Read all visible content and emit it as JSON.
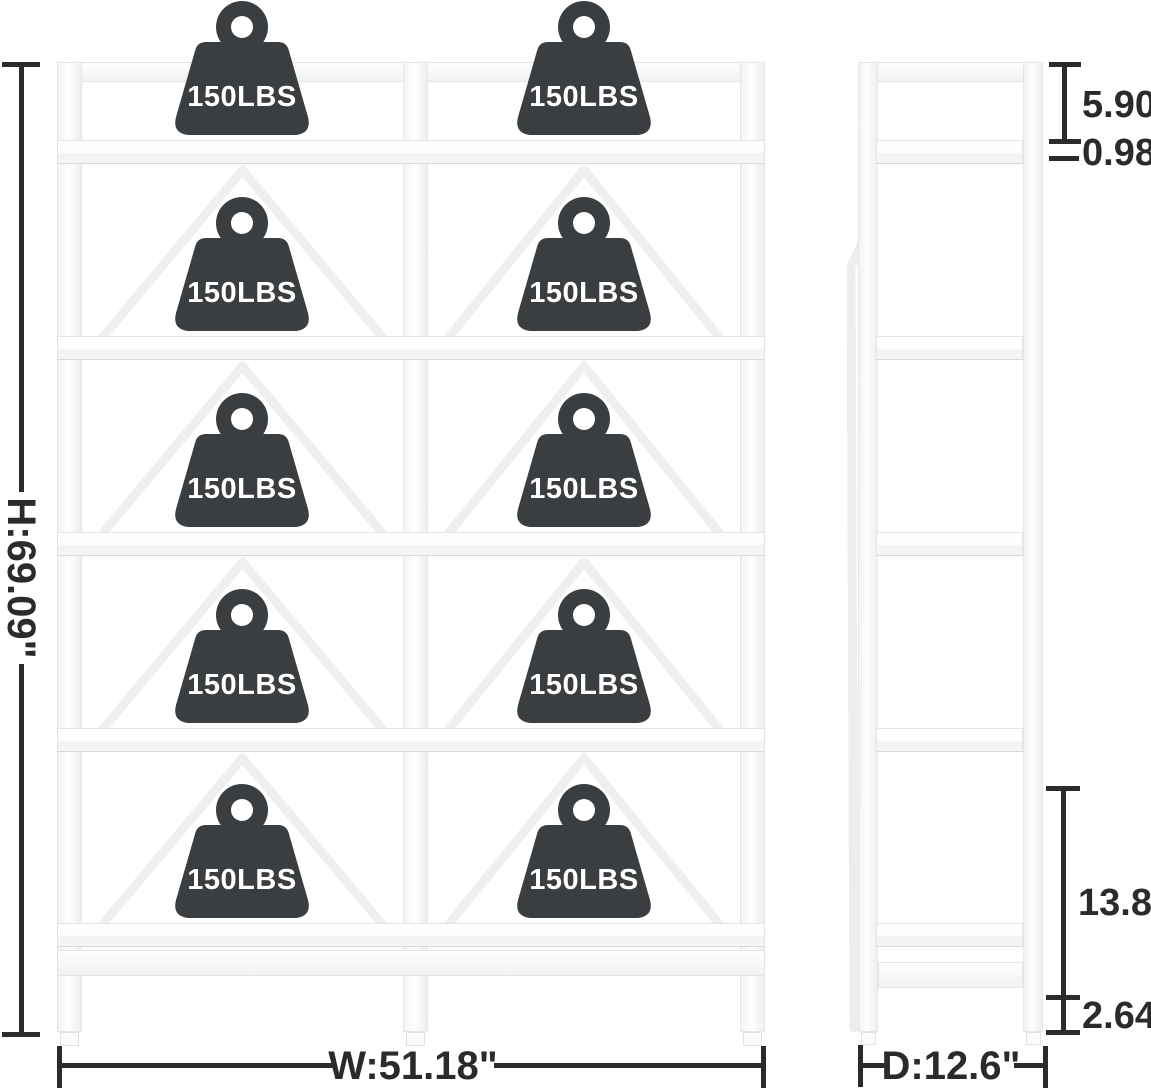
{
  "title": "Bookshelf dimension diagram",
  "views": {
    "front_label": "front view of 5-tier bookshelf",
    "side_label": "side view of 5-tier bookshelf"
  },
  "weights": {
    "label": "150LBS",
    "count": 10
  },
  "dimensions": {
    "height": "H:69.09\"",
    "width": "W:51.18\"",
    "depth": "D:12.6\"",
    "top_gap": "5.90\"",
    "shelf_thickness": "0.98\"",
    "bottom_spacing": "13.82\"",
    "foot_height": "2.64\""
  },
  "colors": {
    "background": "#ffffff",
    "weight_fill": "#3b3e41",
    "weight_text": "#ffffff",
    "dimension_ink": "#2b2b2b",
    "frame_fill": "#fcfcfd",
    "frame_edge": "#e3e5e6",
    "brace": "#eef0f0"
  }
}
